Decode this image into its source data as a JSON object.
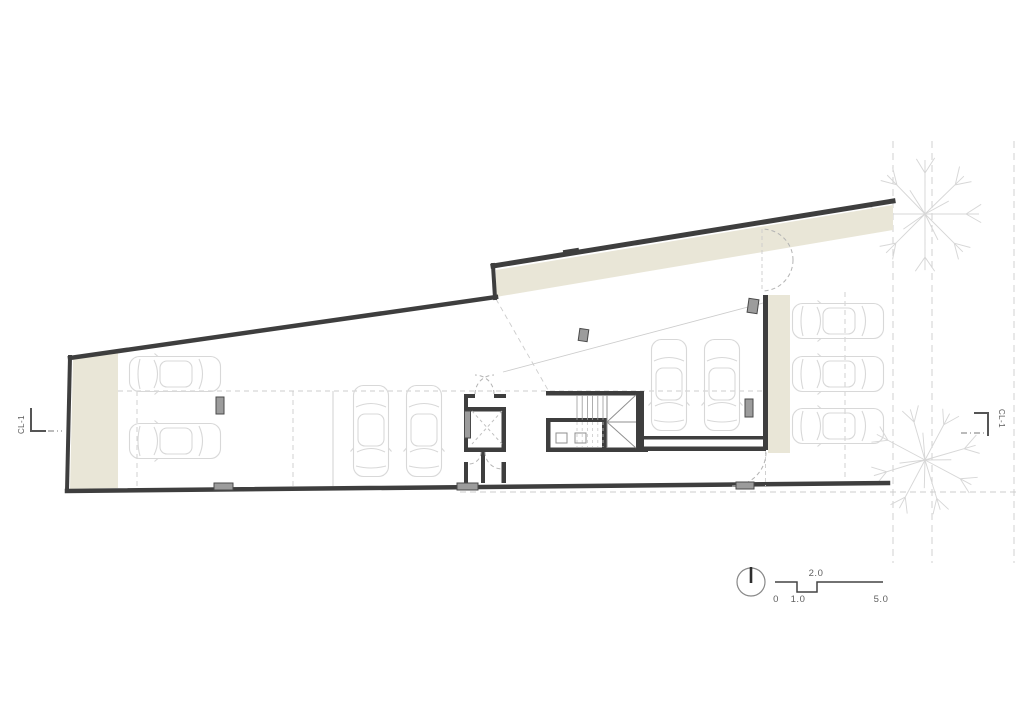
{
  "drawing": {
    "type": "architectural-floor-plan",
    "section_markers": {
      "left": "CL-1",
      "right": "CL-1"
    },
    "scale_bar": {
      "zero": "0",
      "one": "1.0",
      "two": "2.0",
      "five": "5.0"
    },
    "icons": {
      "north": "north-indicator-circle",
      "tree": "tree-plan-symbol",
      "car": "car-plan-symbol",
      "stair": "stair-run-with-cross",
      "elevator": "elevator-shaft-cross"
    },
    "colors": {
      "wall": "#3e3e3e",
      "band": "#e9e6d7",
      "column": "#9c9c9c",
      "car_outline": "#d8d8d8",
      "guide": "#cccccc",
      "text": "#5f5f5f"
    }
  }
}
